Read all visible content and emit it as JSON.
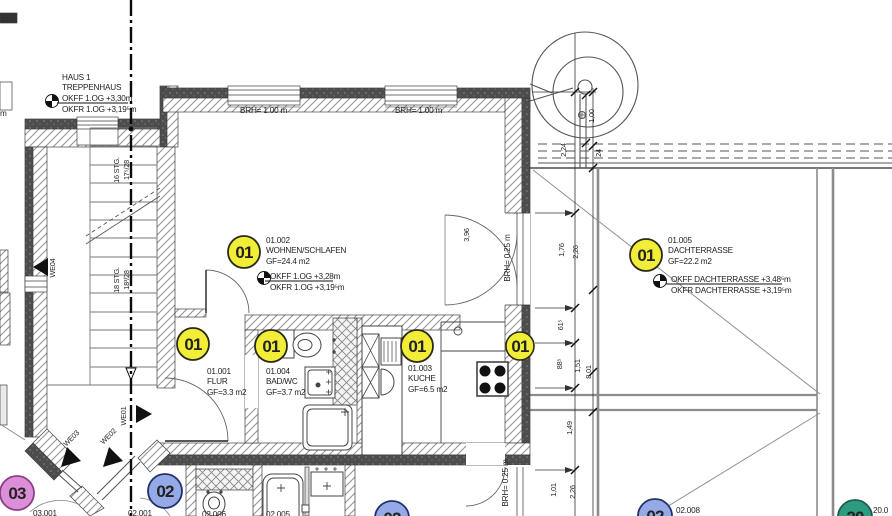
{
  "rooms": {
    "treppenhaus": {
      "line1": "HAUS 1",
      "line2": "TREPPENHAUS",
      "okff": "OKFF 1.OG +3,30m",
      "okfr": "OKFR 1.OG +3,19⁵m"
    },
    "wohnen": {
      "number": "01.002",
      "name": "WOHNEN/SCHLAFEN",
      "area": "GF=24.4 m2",
      "okff": "OKFF 1.OG +3,28m",
      "okfr": "OKFR 1.OG +3,19⁵m"
    },
    "dachterrasse": {
      "number": "01.005",
      "name": "DACHTERRASSE",
      "area": "GF=22.2 m2",
      "okff": "OKFF DACHTERRASSE +3,48⁵m",
      "okfr": "OKFR DACHTERRASSE +3,19⁵m"
    },
    "flur": {
      "number": "01.001",
      "name": "FLUR",
      "area": "GF=3.3 m2"
    },
    "bad": {
      "number": "01.004",
      "name": "BAD/WC",
      "area": "GF=3.7 m2"
    },
    "kueche": {
      "number": "01.003",
      "name": "KUCHE",
      "area": "GF=6.5 m2"
    }
  },
  "windows": {
    "brh_top_left": "BRH= 1.00 m",
    "brh_top_right": "BRH= 1.00 m",
    "brh_right_upper": "BRH= 0.25 m",
    "brh_right_lower": "BRH= 0.25 m"
  },
  "stair": {
    "upper1": "16 STG.",
    "upper2": "17⁵/28",
    "lower1": "18 STG.",
    "lower2": "18³/28"
  },
  "entrances": {
    "we01": "WE01",
    "we02": "WE02",
    "we03": "WE03",
    "we04": "WE04"
  },
  "badges": {
    "u01": "01",
    "u02": "02",
    "u03": "03",
    "u20": "20"
  },
  "bottom_labels": {
    "l03001": "03.001",
    "l02001": "02.001",
    "l02006": "02.006",
    "l02005": "02.005",
    "l02008": "02.008",
    "l20": "20.0"
  },
  "dims": {
    "d224": "2,24",
    "d176": "1,76",
    "d615": "61⁵",
    "d885": "88⁵",
    "d149": "1,49",
    "d101": "1,01",
    "d226a": "2,26",
    "d151": "1,51",
    "d226b": "2,26",
    "d801": "8,01",
    "d100": "1,00",
    "d24": "24",
    "d396": "3,96"
  },
  "fragments": {
    "left_m": "m"
  },
  "colors": {
    "badge_yellow": "#f2ee38",
    "badge_blue": "#94a9e6",
    "badge_pink": "#dd8ed8",
    "badge_green": "#2d9b80",
    "wall_dark": "#4d4d4d",
    "hatch_line": "#969696",
    "line": "#3f3f3f",
    "terrace_gray": "#8c8c8c"
  }
}
